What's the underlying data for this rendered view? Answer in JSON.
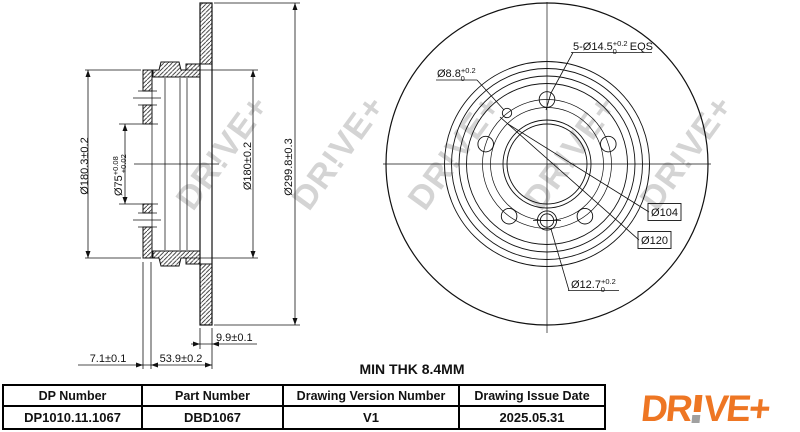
{
  "sheet": {
    "background": "#ffffff",
    "line_color": "#111111"
  },
  "watermark": {
    "text": "DR!VE+",
    "color": "#d4d4d4"
  },
  "section_view": {
    "dims": {
      "hat_outer_diameter": "Ø180.3±0.2",
      "bore": {
        "main": "Ø75",
        "tol_upper": "+0.08",
        "tol_lower": "+0.02"
      },
      "hat_inner_diameter": "Ø180±0.2",
      "outer_diameter": "Ø299.8±0.3",
      "disc_thickness": "9.9±0.1",
      "total_height": "53.9±0.2",
      "flange_thickness": "7.1±0.1"
    }
  },
  "front_view": {
    "bolt_holes": {
      "prefix": "5-Ø14.5",
      "tol_upper": "+0.2",
      "tol_lower": "0",
      "suffix": "EQS"
    },
    "hole_8_8": {
      "main": "Ø8.8",
      "tol_upper": "+0.2",
      "tol_lower": "0"
    },
    "circle_104": "Ø104",
    "circle_120": "Ø120",
    "hole_12_7": {
      "main": "Ø12.7",
      "tol_upper": "+0.2",
      "tol_lower": "0"
    }
  },
  "notes": {
    "min_thickness": "MIN THK 8.4MM"
  },
  "title_block": {
    "columns": [
      {
        "header": "DP Number",
        "value": "DP1010.11.1067"
      },
      {
        "header": "Part Number",
        "value": "DBD1067"
      },
      {
        "header": "Drawing Version Number",
        "value": "V1"
      },
      {
        "header": "Drawing Issue Date",
        "value": "2025.05.31"
      }
    ]
  },
  "logo": {
    "text": "DR!VE+",
    "part1": "DR",
    "part2": "VE+",
    "orange": "#EE7623",
    "dot_gray": "#A0A0A0"
  }
}
